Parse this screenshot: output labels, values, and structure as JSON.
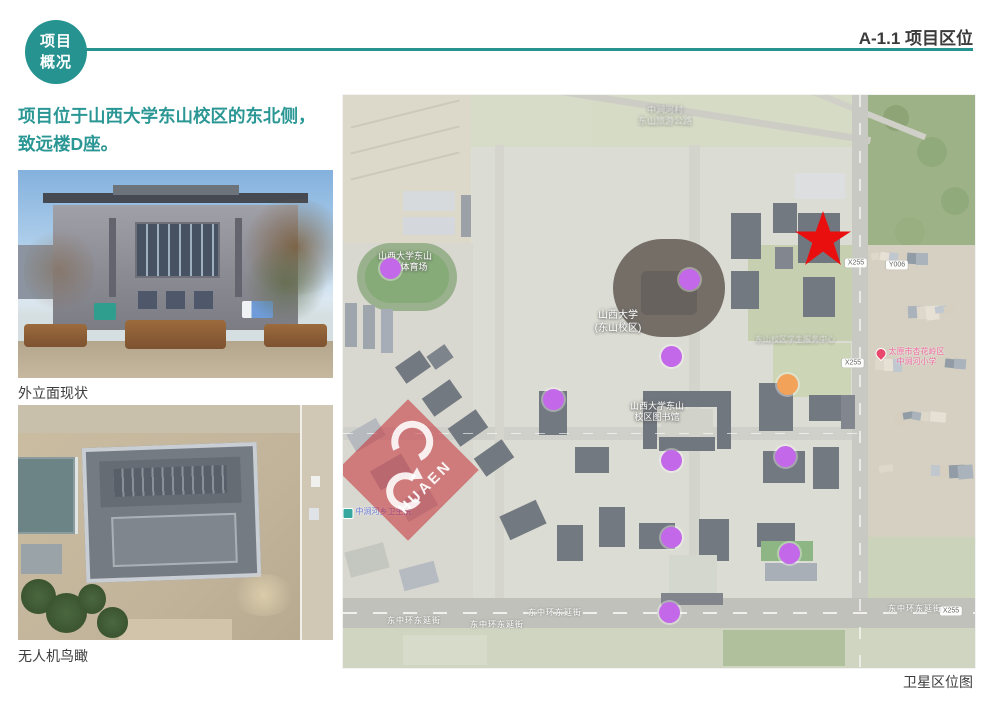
{
  "page": {
    "background": "#ffffff",
    "accent_color": "#279391"
  },
  "header": {
    "badge": {
      "line1": "项目",
      "line2": "概况"
    },
    "section_label": "A-1.1 项目区位"
  },
  "intro": {
    "line1": "项目位于山西大学东山校区的东北侧，",
    "line2": "致远楼D座。"
  },
  "photos": [
    {
      "caption": "外立面现状"
    },
    {
      "caption": "无人机鸟瞰"
    }
  ],
  "map": {
    "caption": "卫星区位图",
    "watermark": {
      "logo_text": "HUAEN",
      "color": "#c7262e"
    },
    "site_marker": {
      "shape": "star",
      "color": "#ea0f0f",
      "x": 480,
      "y": 143
    },
    "dots": [
      {
        "name": "poi-dot-1",
        "x": 47,
        "y": 173,
        "color": "#c368e8"
      },
      {
        "name": "poi-dot-2",
        "x": 346,
        "y": 184,
        "color": "#c368e8"
      },
      {
        "name": "poi-dot-3",
        "x": 328,
        "y": 261,
        "color": "#c368e8"
      },
      {
        "name": "poi-dot-4",
        "x": 210,
        "y": 304,
        "color": "#c368e8"
      },
      {
        "name": "poi-dot-5",
        "x": 328,
        "y": 365,
        "color": "#c368e8"
      },
      {
        "name": "poi-dot-6",
        "x": 442,
        "y": 361,
        "color": "#c368e8"
      },
      {
        "name": "poi-dot-7",
        "x": 328,
        "y": 442,
        "color": "#c368e8"
      },
      {
        "name": "poi-dot-8",
        "x": 446,
        "y": 458,
        "color": "#c368e8"
      },
      {
        "name": "poi-dot-9",
        "x": 326,
        "y": 517,
        "color": "#c368e8"
      },
      {
        "name": "poi-dot-orange",
        "x": 444,
        "y": 289,
        "color": "#f2a259"
      }
    ],
    "labels": [
      {
        "id": "village-north-label",
        "lines": [
          "中涧河村",
          "东山旅游公路"
        ],
        "x": 322,
        "y": 10,
        "style": "white faint",
        "size": 9
      },
      {
        "id": "stadium-label",
        "lines": [
          "山西大学东山",
          "校区体育场"
        ],
        "x": 62,
        "y": 156,
        "style": "white",
        "size": 9
      },
      {
        "id": "campus-label",
        "lines": [
          "山西大学",
          "(东山校区)"
        ],
        "x": 275,
        "y": 215,
        "style": "white",
        "size": 10
      },
      {
        "id": "library-label",
        "lines": [
          "山西大学东山",
          "校区图书馆"
        ],
        "x": 314,
        "y": 306,
        "style": "white",
        "size": 9
      },
      {
        "id": "service-center-label",
        "lines": [
          "东山校区学生服务中心"
        ],
        "x": 452,
        "y": 240,
        "style": "white faint",
        "size": 8
      },
      {
        "id": "school-poi-label",
        "lines": [
          "太原市杏花岭区",
          "中涧河小学"
        ],
        "x": 567,
        "y": 252,
        "style": "pink",
        "size": 8,
        "icon": "pin"
      },
      {
        "id": "clinic-poi-label",
        "lines": [
          "中涧河乡卫生院"
        ],
        "x": 34,
        "y": 412,
        "style": "blue",
        "size": 8,
        "icon": "square"
      }
    ],
    "road_shields": [
      {
        "text": "X255",
        "x": 513,
        "y": 168
      },
      {
        "text": "Y006",
        "x": 554,
        "y": 170
      },
      {
        "text": "X255",
        "x": 510,
        "y": 268
      },
      {
        "text": "X255",
        "x": 608,
        "y": 516
      }
    ],
    "road_names": [
      {
        "text": "东中环东延街",
        "x": 71,
        "y": 520
      },
      {
        "text": "东中环东延街",
        "x": 154,
        "y": 524
      },
      {
        "text": "东中环东延街",
        "x": 212,
        "y": 512
      },
      {
        "text": "东中环东延街",
        "x": 572,
        "y": 508
      }
    ]
  }
}
